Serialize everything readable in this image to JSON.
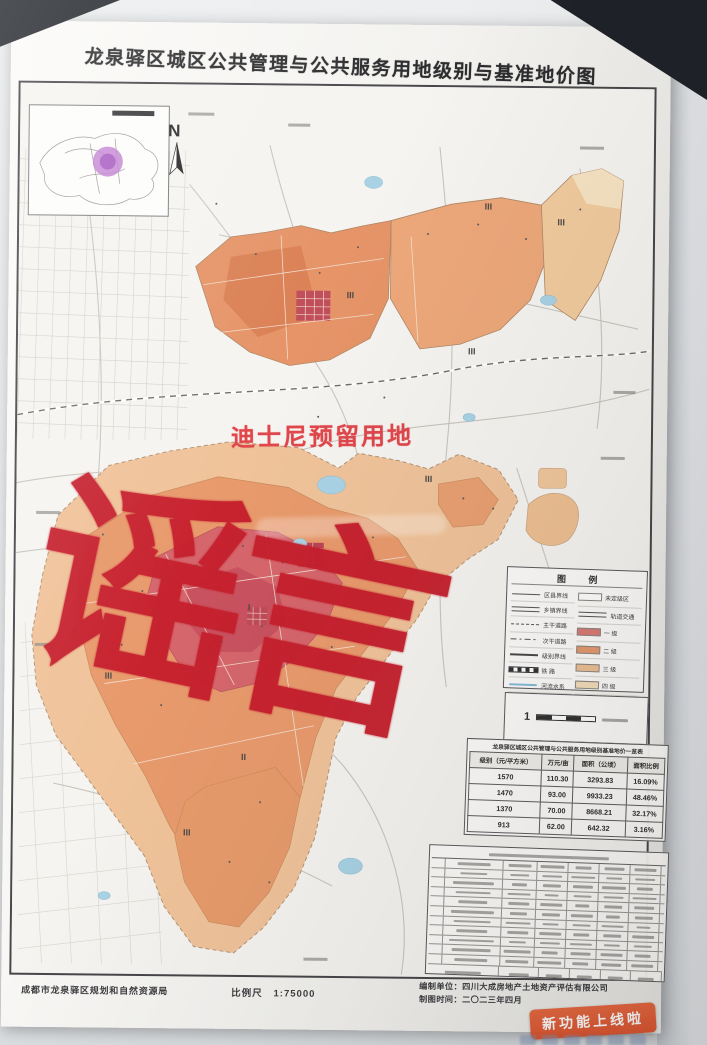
{
  "map": {
    "title": "龙泉驿区城区公共管理与公共服务用地级别与基准地价图",
    "north_label": "N",
    "red_annotation": "迪士尼预留用地",
    "watermark_text": "谣言",
    "zone_labels": [
      {
        "t": "III",
        "x": 469,
        "y": 119
      },
      {
        "t": "III",
        "x": 332,
        "y": 209
      },
      {
        "t": "III",
        "x": 454,
        "y": 264
      },
      {
        "t": "III",
        "x": 542,
        "y": 134
      },
      {
        "t": "III",
        "x": 412,
        "y": 392
      },
      {
        "t": "III",
        "x": 94,
        "y": 592
      },
      {
        "t": "III",
        "x": 174,
        "y": 748
      },
      {
        "t": "II",
        "x": 60,
        "y": 547
      },
      {
        "t": "II",
        "x": 354,
        "y": 474
      },
      {
        "t": "II",
        "x": 230,
        "y": 672
      },
      {
        "t": "I",
        "x": 234,
        "y": 522
      }
    ],
    "legend": {
      "title": "图 例",
      "left_items": [
        {
          "label": "区县界线",
          "symbol": "solid"
        },
        {
          "label": "乡镇界线",
          "symbol": "double"
        },
        {
          "label": "主干道路",
          "symbol": "dashed"
        },
        {
          "label": "次干道路",
          "symbol": "dashdot"
        },
        {
          "label": "级别界线",
          "symbol": "thick"
        },
        {
          "label": "铁 路",
          "symbol": "rail"
        },
        {
          "label": "河流水系",
          "symbol": "water"
        }
      ],
      "right_items": [
        {
          "label": "未定级区",
          "swatch": "#ffffff"
        },
        {
          "label": "轨道交通",
          "swatch": "line"
        },
        {
          "label": "一 级",
          "swatch": "#d97b74"
        },
        {
          "label": "二 级",
          "swatch": "#e59a70"
        },
        {
          "label": "三 级",
          "swatch": "#eec094"
        },
        {
          "label": "四 级",
          "swatch": "#f4debb"
        }
      ]
    },
    "price_table": {
      "title": "龙泉驿区城区公共管理与公共服务用地级别基准地价一览表",
      "columns": [
        "级别（元/平方米）",
        "万元/亩",
        "面积（公顷）",
        "面积比例"
      ],
      "rows": [
        [
          "1570",
          "110.30",
          "3293.83",
          "16.09%"
        ],
        [
          "1470",
          "93.00",
          "9933.23",
          "48.46%"
        ],
        [
          "1370",
          "70.00",
          "8668.21",
          "32.17%"
        ],
        [
          "913",
          "62.00",
          "642.32",
          "3.16%"
        ]
      ]
    },
    "scale_label": "比例尺",
    "scale_value": "1:75000",
    "agency": "成都市龙泉驿区规划和自然资源局",
    "credits": {
      "producer_label": "编制单位：",
      "producer": "四川大成房地产土地资产评估有限公司",
      "date_label": "制图时间：",
      "date": "二〇二三年四月"
    },
    "stamp_text": "新功能上线啦",
    "colors": {
      "level1": "#d9666c",
      "level2": "#e89a6c",
      "level3": "#f0c39a",
      "level4": "#f4debb",
      "water": "#a9d3e5",
      "watermark_red": "#c6202e",
      "annotation_red": "#e0474c",
      "stamp_orange": "#e05a31",
      "inset_highlight": "#c27fd1"
    }
  }
}
